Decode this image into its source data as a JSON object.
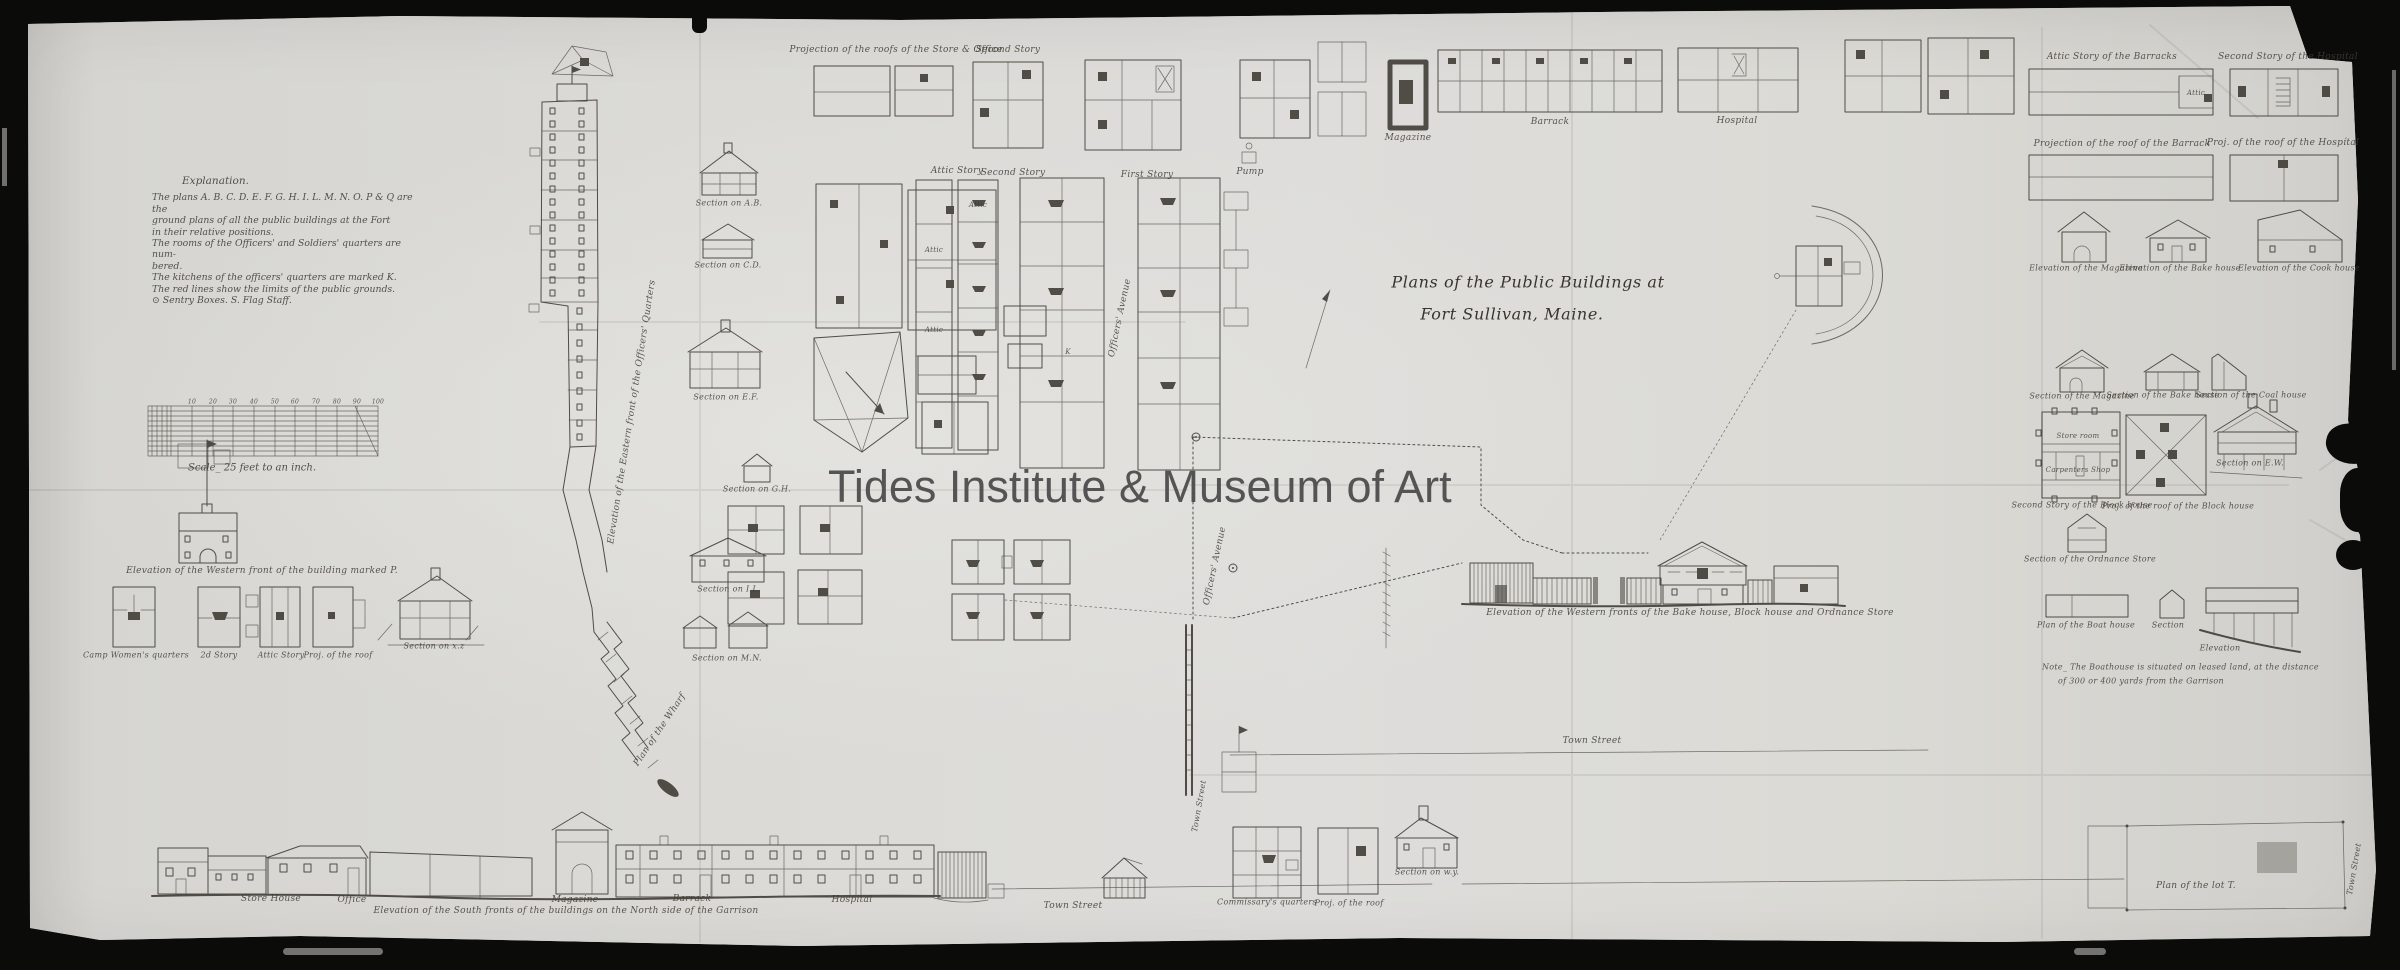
{
  "watermark": {
    "text": "Tides Institute & Museum of Art"
  },
  "title": {
    "line1": "Plans of the Public Buildings at",
    "line2": "Fort Sullivan, Maine."
  },
  "explanation": {
    "heading": "Explanation.",
    "lines": [
      "The plans A. B. C. D. E. F. G. H. I. L. M. N. O. P & Q are the",
      "ground plans of all the public buildings at the Fort",
      "in their relative positions.",
      "The rooms of the Officers' and Soldiers' quarters are num-",
      "bered.",
      "The kitchens of the officers' quarters are marked K.",
      "The red lines show the limits of the public grounds.",
      "⊙ Sentry Boxes.   S. Flag Staff."
    ]
  },
  "scale": {
    "caption": "Scale_ 25 feet to an inch."
  },
  "colors": {
    "paper": "#d8d7d3",
    "ink": "#3a3830",
    "frame": "#0b0b0a",
    "watermark": "#4c4c4c"
  },
  "annotations": [
    {
      "t": "Projection of the roofs of the Store & Office",
      "x": 896,
      "y": 50,
      "s": 9
    },
    {
      "t": "Second Story",
      "x": 1008,
      "y": 50,
      "s": 9
    },
    {
      "t": "Attic Story",
      "x": 957,
      "y": 171,
      "s": 9
    },
    {
      "t": "Second Story",
      "x": 1013,
      "y": 173,
      "s": 9
    },
    {
      "t": "First Story",
      "x": 1147,
      "y": 175,
      "s": 9
    },
    {
      "t": "Pump",
      "x": 1250,
      "y": 172,
      "s": 9
    },
    {
      "t": "Magazine",
      "x": 1408,
      "y": 138,
      "s": 9
    },
    {
      "t": "Barrack",
      "x": 1550,
      "y": 122,
      "s": 9
    },
    {
      "t": "Hospital",
      "x": 1737,
      "y": 121,
      "s": 9
    },
    {
      "t": "Officers' Avenue",
      "x": 1120,
      "y": 318,
      "s": 9,
      "r": -78
    },
    {
      "t": "Officers' Avenue",
      "x": 1215,
      "y": 566,
      "s": 9,
      "r": -78
    },
    {
      "t": "Elevation of the Eastern front of the Officers' Quarters",
      "x": 632,
      "y": 412,
      "s": 9,
      "r": -81
    },
    {
      "t": "Plan of the Wharf",
      "x": 660,
      "y": 730,
      "s": 9,
      "r": -56
    },
    {
      "t": "Attic",
      "x": 934,
      "y": 250,
      "s": 7
    },
    {
      "t": "Attic",
      "x": 934,
      "y": 330,
      "s": 7
    },
    {
      "t": "Attic",
      "x": 978,
      "y": 205,
      "s": 7
    },
    {
      "t": "K",
      "x": 1068,
      "y": 352,
      "s": 7
    },
    {
      "t": "Section on A.B.",
      "x": 729,
      "y": 203,
      "s": 8
    },
    {
      "t": "Section on C.D.",
      "x": 728,
      "y": 265,
      "s": 8
    },
    {
      "t": "Section on E.F.",
      "x": 726,
      "y": 397,
      "s": 8
    },
    {
      "t": "Section on G.H.",
      "x": 757,
      "y": 489,
      "s": 8
    },
    {
      "t": "Section on I.L.",
      "x": 729,
      "y": 589,
      "s": 8
    },
    {
      "t": "Section on M.N.",
      "x": 727,
      "y": 658,
      "s": 8
    },
    {
      "t": "Elevation of the Western front of the building marked P.",
      "x": 262,
      "y": 571,
      "s": 9
    },
    {
      "t": "Camp Women's quarters",
      "x": 136,
      "y": 655,
      "s": 8
    },
    {
      "t": "2d Story",
      "x": 219,
      "y": 655,
      "s": 8
    },
    {
      "t": "Attic Story",
      "x": 281,
      "y": 655,
      "s": 8
    },
    {
      "t": "Proj. of the roof",
      "x": 338,
      "y": 655,
      "s": 8
    },
    {
      "t": "Section on x.z",
      "x": 434,
      "y": 646,
      "s": 8
    },
    {
      "t": "10",
      "x": 192,
      "y": 402,
      "s": 6
    },
    {
      "t": "20",
      "x": 213,
      "y": 402,
      "s": 6
    },
    {
      "t": "30",
      "x": 233,
      "y": 402,
      "s": 6
    },
    {
      "t": "40",
      "x": 254,
      "y": 402,
      "s": 6
    },
    {
      "t": "50",
      "x": 275,
      "y": 402,
      "s": 6
    },
    {
      "t": "60",
      "x": 295,
      "y": 402,
      "s": 6
    },
    {
      "t": "70",
      "x": 316,
      "y": 402,
      "s": 6
    },
    {
      "t": "80",
      "x": 337,
      "y": 402,
      "s": 6
    },
    {
      "t": "90",
      "x": 357,
      "y": 402,
      "s": 6
    },
    {
      "t": "100",
      "x": 378,
      "y": 402,
      "s": 6
    },
    {
      "t": "Town Street",
      "x": 1592,
      "y": 741,
      "s": 9
    },
    {
      "t": "Elevation of the Western fronts of the Bake house, Block house and Ordnance Store",
      "x": 1690,
      "y": 613,
      "s": 9
    },
    {
      "t": "Town Street",
      "x": 1199,
      "y": 806,
      "s": 8,
      "r": -80
    },
    {
      "t": "Store House",
      "x": 271,
      "y": 899,
      "s": 9
    },
    {
      "t": "Office",
      "x": 352,
      "y": 900,
      "s": 9
    },
    {
      "t": "Magazine",
      "x": 575,
      "y": 900,
      "s": 9
    },
    {
      "t": "Barrack",
      "x": 692,
      "y": 899,
      "s": 9
    },
    {
      "t": "Hospital",
      "x": 852,
      "y": 900,
      "s": 9
    },
    {
      "t": "Elevation of the South fronts of the buildings on the North side of the Garrison",
      "x": 566,
      "y": 911,
      "s": 9
    },
    {
      "t": "Town Street",
      "x": 1073,
      "y": 906,
      "s": 9
    },
    {
      "t": "Commissary's quarters",
      "x": 1267,
      "y": 902,
      "s": 8
    },
    {
      "t": "Proj. of the roof",
      "x": 1349,
      "y": 903,
      "s": 8
    },
    {
      "t": "Section on w.y.",
      "x": 1427,
      "y": 872,
      "s": 8
    },
    {
      "t": "Plan of the lot T.",
      "x": 2196,
      "y": 886,
      "s": 9
    },
    {
      "t": "Town Street",
      "x": 2354,
      "y": 869,
      "s": 8,
      "r": -80
    },
    {
      "t": "Attic Story of the Barracks",
      "x": 2112,
      "y": 57,
      "s": 9
    },
    {
      "t": "Second Story of the Hospital",
      "x": 2288,
      "y": 57,
      "s": 9
    },
    {
      "t": "Attic",
      "x": 2196,
      "y": 93,
      "s": 7
    },
    {
      "t": "Projection of the roof of the Barrack",
      "x": 2122,
      "y": 144,
      "s": 9
    },
    {
      "t": "Proj. of the roof of the Hospítal",
      "x": 2283,
      "y": 143,
      "s": 9
    },
    {
      "t": "Elevation of the Magazine",
      "x": 2086,
      "y": 268,
      "s": 8
    },
    {
      "t": "Elevation of the Bake house",
      "x": 2180,
      "y": 268,
      "s": 8
    },
    {
      "t": "Elevation of the Cook house",
      "x": 2299,
      "y": 268,
      "s": 8
    },
    {
      "t": "Section of the Magazine",
      "x": 2082,
      "y": 396,
      "s": 8
    },
    {
      "t": "Section of the Bake house",
      "x": 2163,
      "y": 395,
      "s": 8
    },
    {
      "t": "Section of the Coal house",
      "x": 2251,
      "y": 395,
      "s": 8
    },
    {
      "t": "Store room",
      "x": 2078,
      "y": 436,
      "s": 7
    },
    {
      "t": "Carpenters Shop",
      "x": 2078,
      "y": 470,
      "s": 7
    },
    {
      "t": "Second Story of the Block house",
      "x": 2082,
      "y": 505,
      "s": 8
    },
    {
      "t": "Proj. of the roof of the Block house",
      "x": 2178,
      "y": 506,
      "s": 8
    },
    {
      "t": "Section on E.W.",
      "x": 2250,
      "y": 463,
      "s": 8
    },
    {
      "t": "Section of the Ordnance Store",
      "x": 2090,
      "y": 559,
      "s": 8
    },
    {
      "t": "Plan of the Boat house",
      "x": 2086,
      "y": 625,
      "s": 8
    },
    {
      "t": "Section",
      "x": 2168,
      "y": 625,
      "s": 8
    },
    {
      "t": "Elevation",
      "x": 2220,
      "y": 648,
      "s": 8
    },
    {
      "t": "Note_ The Boathouse is situated on leased land, at the distance",
      "x": 2042,
      "y": 667,
      "s": 8,
      "al": "left"
    },
    {
      "t": "of 300 or 400 yards from the Garrison",
      "x": 2058,
      "y": 681,
      "s": 8,
      "al": "left"
    }
  ]
}
